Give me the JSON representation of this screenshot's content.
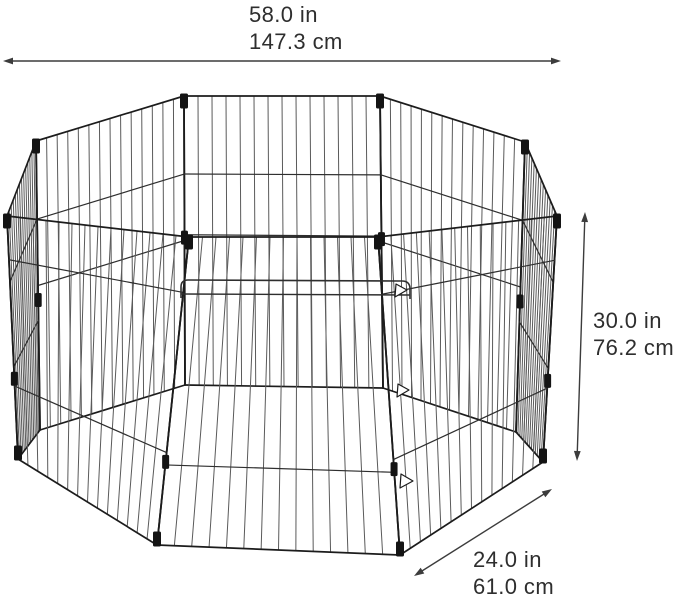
{
  "figure": {
    "label": "8-panel octagonal wire pet playpen",
    "panel_count": 8,
    "colors": {
      "background": "#ffffff",
      "wire_edge": "#1c1c1c",
      "wire": "#5a5a5a",
      "rail": "#2e2e2e",
      "connector": "#141414",
      "dimension_line": "#3c3c3c",
      "text": "#2e2e2e"
    }
  },
  "dimensions": {
    "width": {
      "label_in": "58.0 in",
      "label_cm": "147.3 cm"
    },
    "height": {
      "label_in": "30.0 in",
      "label_cm": "76.2 cm"
    },
    "panel": {
      "label_in": "24.0 in",
      "label_cm": "61.0 cm"
    }
  }
}
